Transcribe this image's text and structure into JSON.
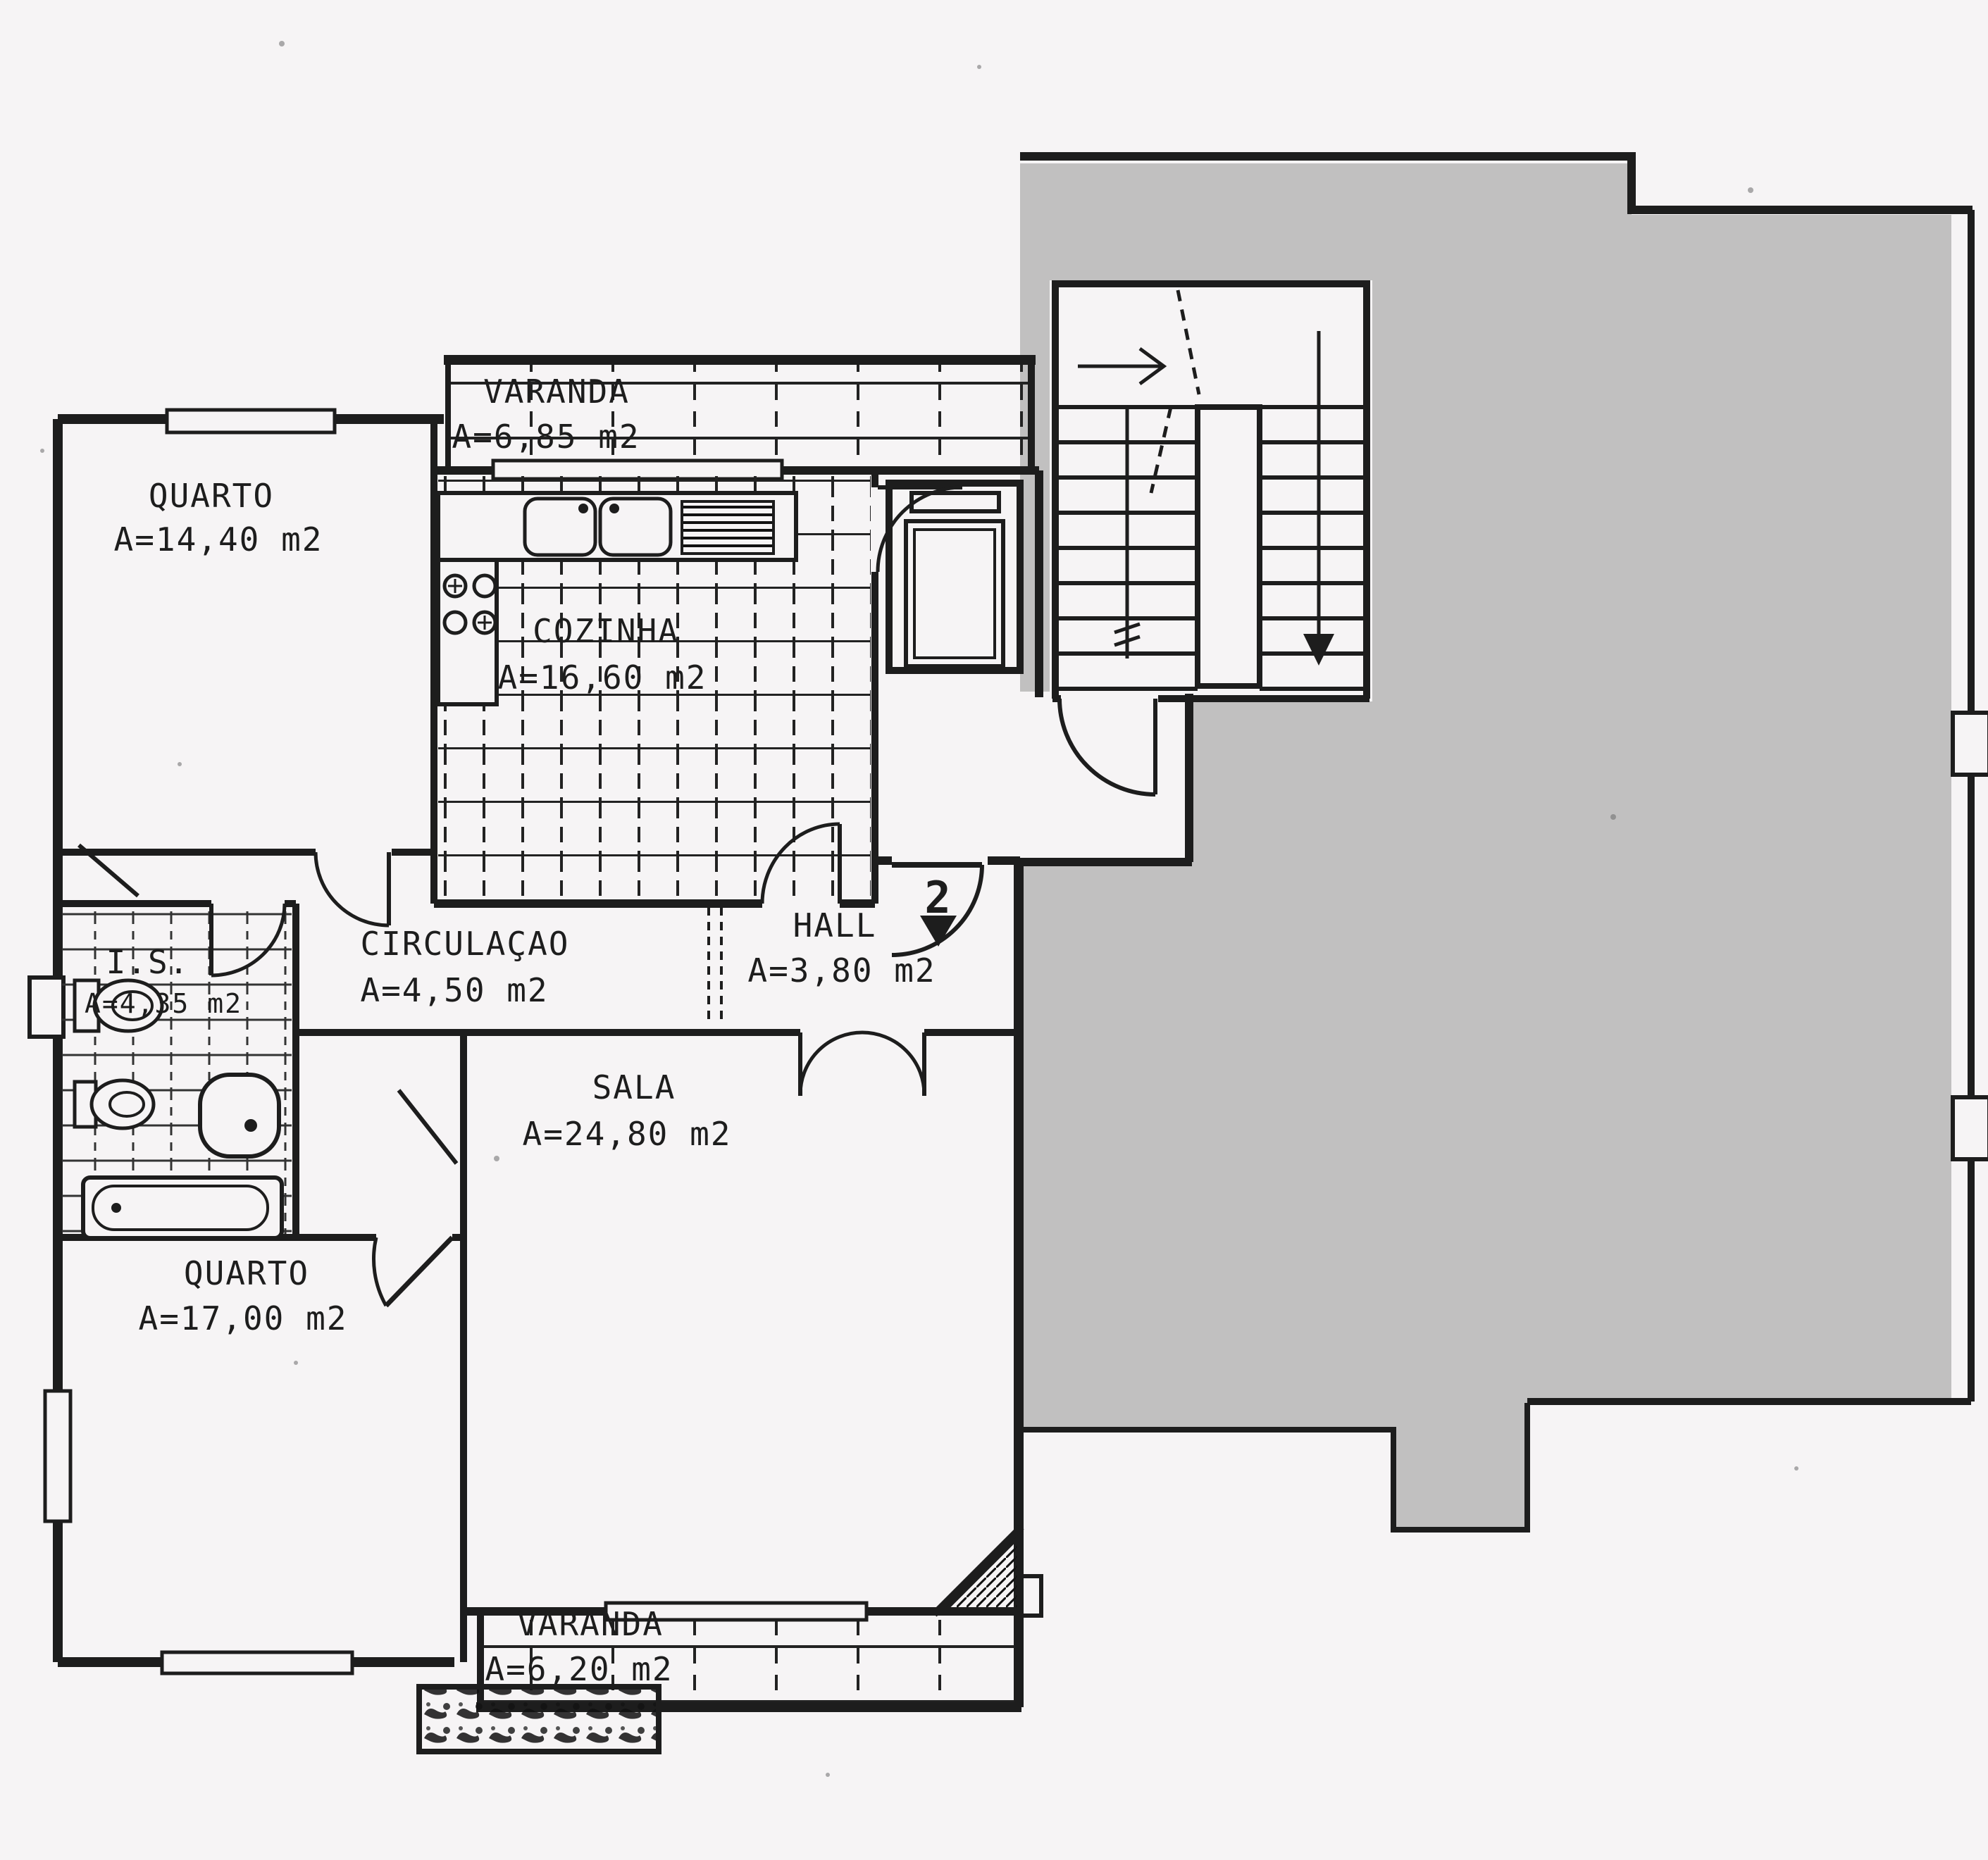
{
  "document": {
    "type": "apartment floor plan (scanned)",
    "unit_number": "2"
  },
  "colors": {
    "paper": "#f6f4f5",
    "ink": "#1d1d1d",
    "neighbor_mask_gray": "#c1c0c0"
  },
  "rooms": {
    "varanda_top": {
      "name": "VARANDA",
      "area": "A=6,85  m2"
    },
    "quarto_1": {
      "name": "QUARTO",
      "area": "A=14,40  m2"
    },
    "cozinha": {
      "name": "COZINHA",
      "area": "A=16,60  m2"
    },
    "circulacao": {
      "name": "CIRCULAÇAO",
      "area": "A=4,50  m2"
    },
    "hall": {
      "name": "HALL",
      "area": "A=3,80  m2"
    },
    "is": {
      "name": "I.S.",
      "area": "A=4,35 m2"
    },
    "sala": {
      "name": "SALA",
      "area": "A=24,80  m2"
    },
    "quarto_2": {
      "name": "QUARTO",
      "area": "A=17,00  m2"
    },
    "varanda_bottom": {
      "name": "VARANDA",
      "area": "A=6,20  m2"
    }
  }
}
